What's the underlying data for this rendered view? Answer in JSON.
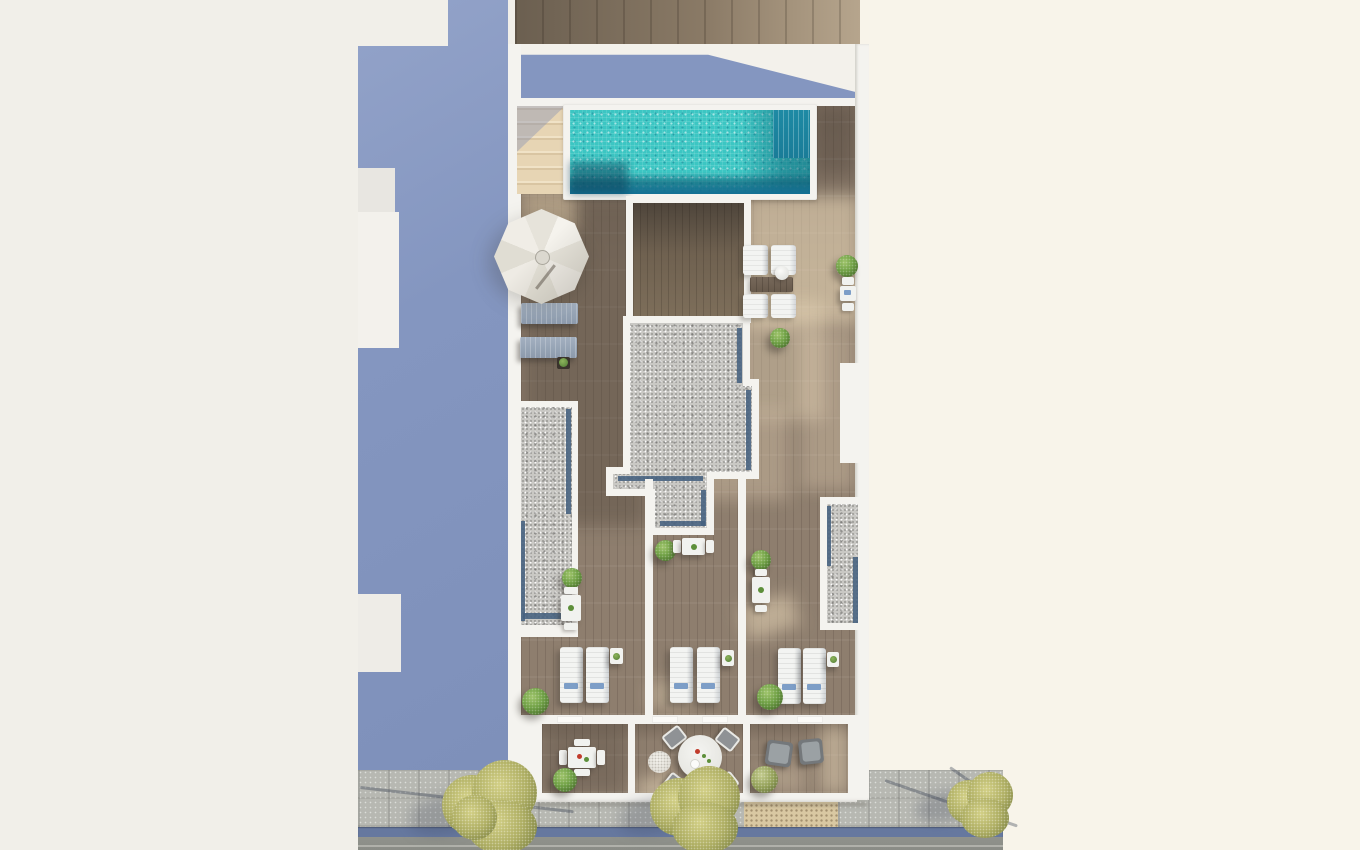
{
  "scene": {
    "type": "architectural-3d-render",
    "view": "top-down aerial plan view",
    "subject": "Rooftop terrace / solarium floor plan render: lap pool with mosaic tiles, access stairs, white parasol, shaded and sunlit timber decks, gravel roof sections with drainage channels, three private terraces with sun loungers, three lower balconies with dining and lounge furniture, and a street with sidewalk, gutter, tactile paving and trees at the bottom. A large periwinkle building shadow falls on the neighbouring plot at left.",
    "text_content": "none — the image contains no visible text"
  },
  "colors": {
    "bg_left": "#f1efe9",
    "bg_right": "#f8f4ea",
    "shadow_blue": "#8496c0",
    "wall_white": "#f4f3ef",
    "wood_top_dark": "#6b5f50",
    "wood_top_light": "#b6a58d",
    "stairs_beige": "#e7d5b4",
    "deck_base": "#8e7e6e",
    "dark_room_wood": "#6f6150",
    "pool_water": "#3cc6c3",
    "pool_water_dark": "#1e8aa4",
    "pool_deep": "#137094",
    "gravel": "#c9c8c4",
    "gravel_channel": "#46617f",
    "lounger_white": "#f1f2ef",
    "lounger_gray": "#8c9aac",
    "umbrella_white": "#f0ede6",
    "plant_green": "#6fa045",
    "plant_olive": "#93a058",
    "tree_olive": "#aeae63",
    "sidewalk": "#b7b8b2",
    "gutter_blue": "#66789f",
    "road": "#8a8c86",
    "tactile": "#d9c8a2",
    "towel_blue": "#7d9ec7",
    "accent_red": "#c13c2c",
    "accent_green": "#5d8f3a"
  },
  "objects": [
    {
      "name": "lap-pool",
      "count": 1
    },
    {
      "name": "pool-access-stairs",
      "count": 1
    },
    {
      "name": "white-parasol",
      "count": 1
    },
    {
      "name": "shaded-gray-sun-loungers",
      "count": 2
    },
    {
      "name": "poolside-white-sun-loungers",
      "count": 4
    },
    {
      "name": "terrace-white-sun-loungers",
      "count": 6
    },
    {
      "name": "lounger-side-tables",
      "count": 4
    },
    {
      "name": "small-dining-sets",
      "count": 5
    },
    {
      "name": "round-dining-table-with-4-chairs",
      "count": 1
    },
    {
      "name": "lounge-armchairs",
      "count": 2
    },
    {
      "name": "potted-bushes",
      "count": 10
    },
    {
      "name": "gravel-roof-sections",
      "count": 3
    },
    {
      "name": "street-trees",
      "count": 3
    },
    {
      "name": "tactile-paving-strip",
      "count": 1
    }
  ]
}
